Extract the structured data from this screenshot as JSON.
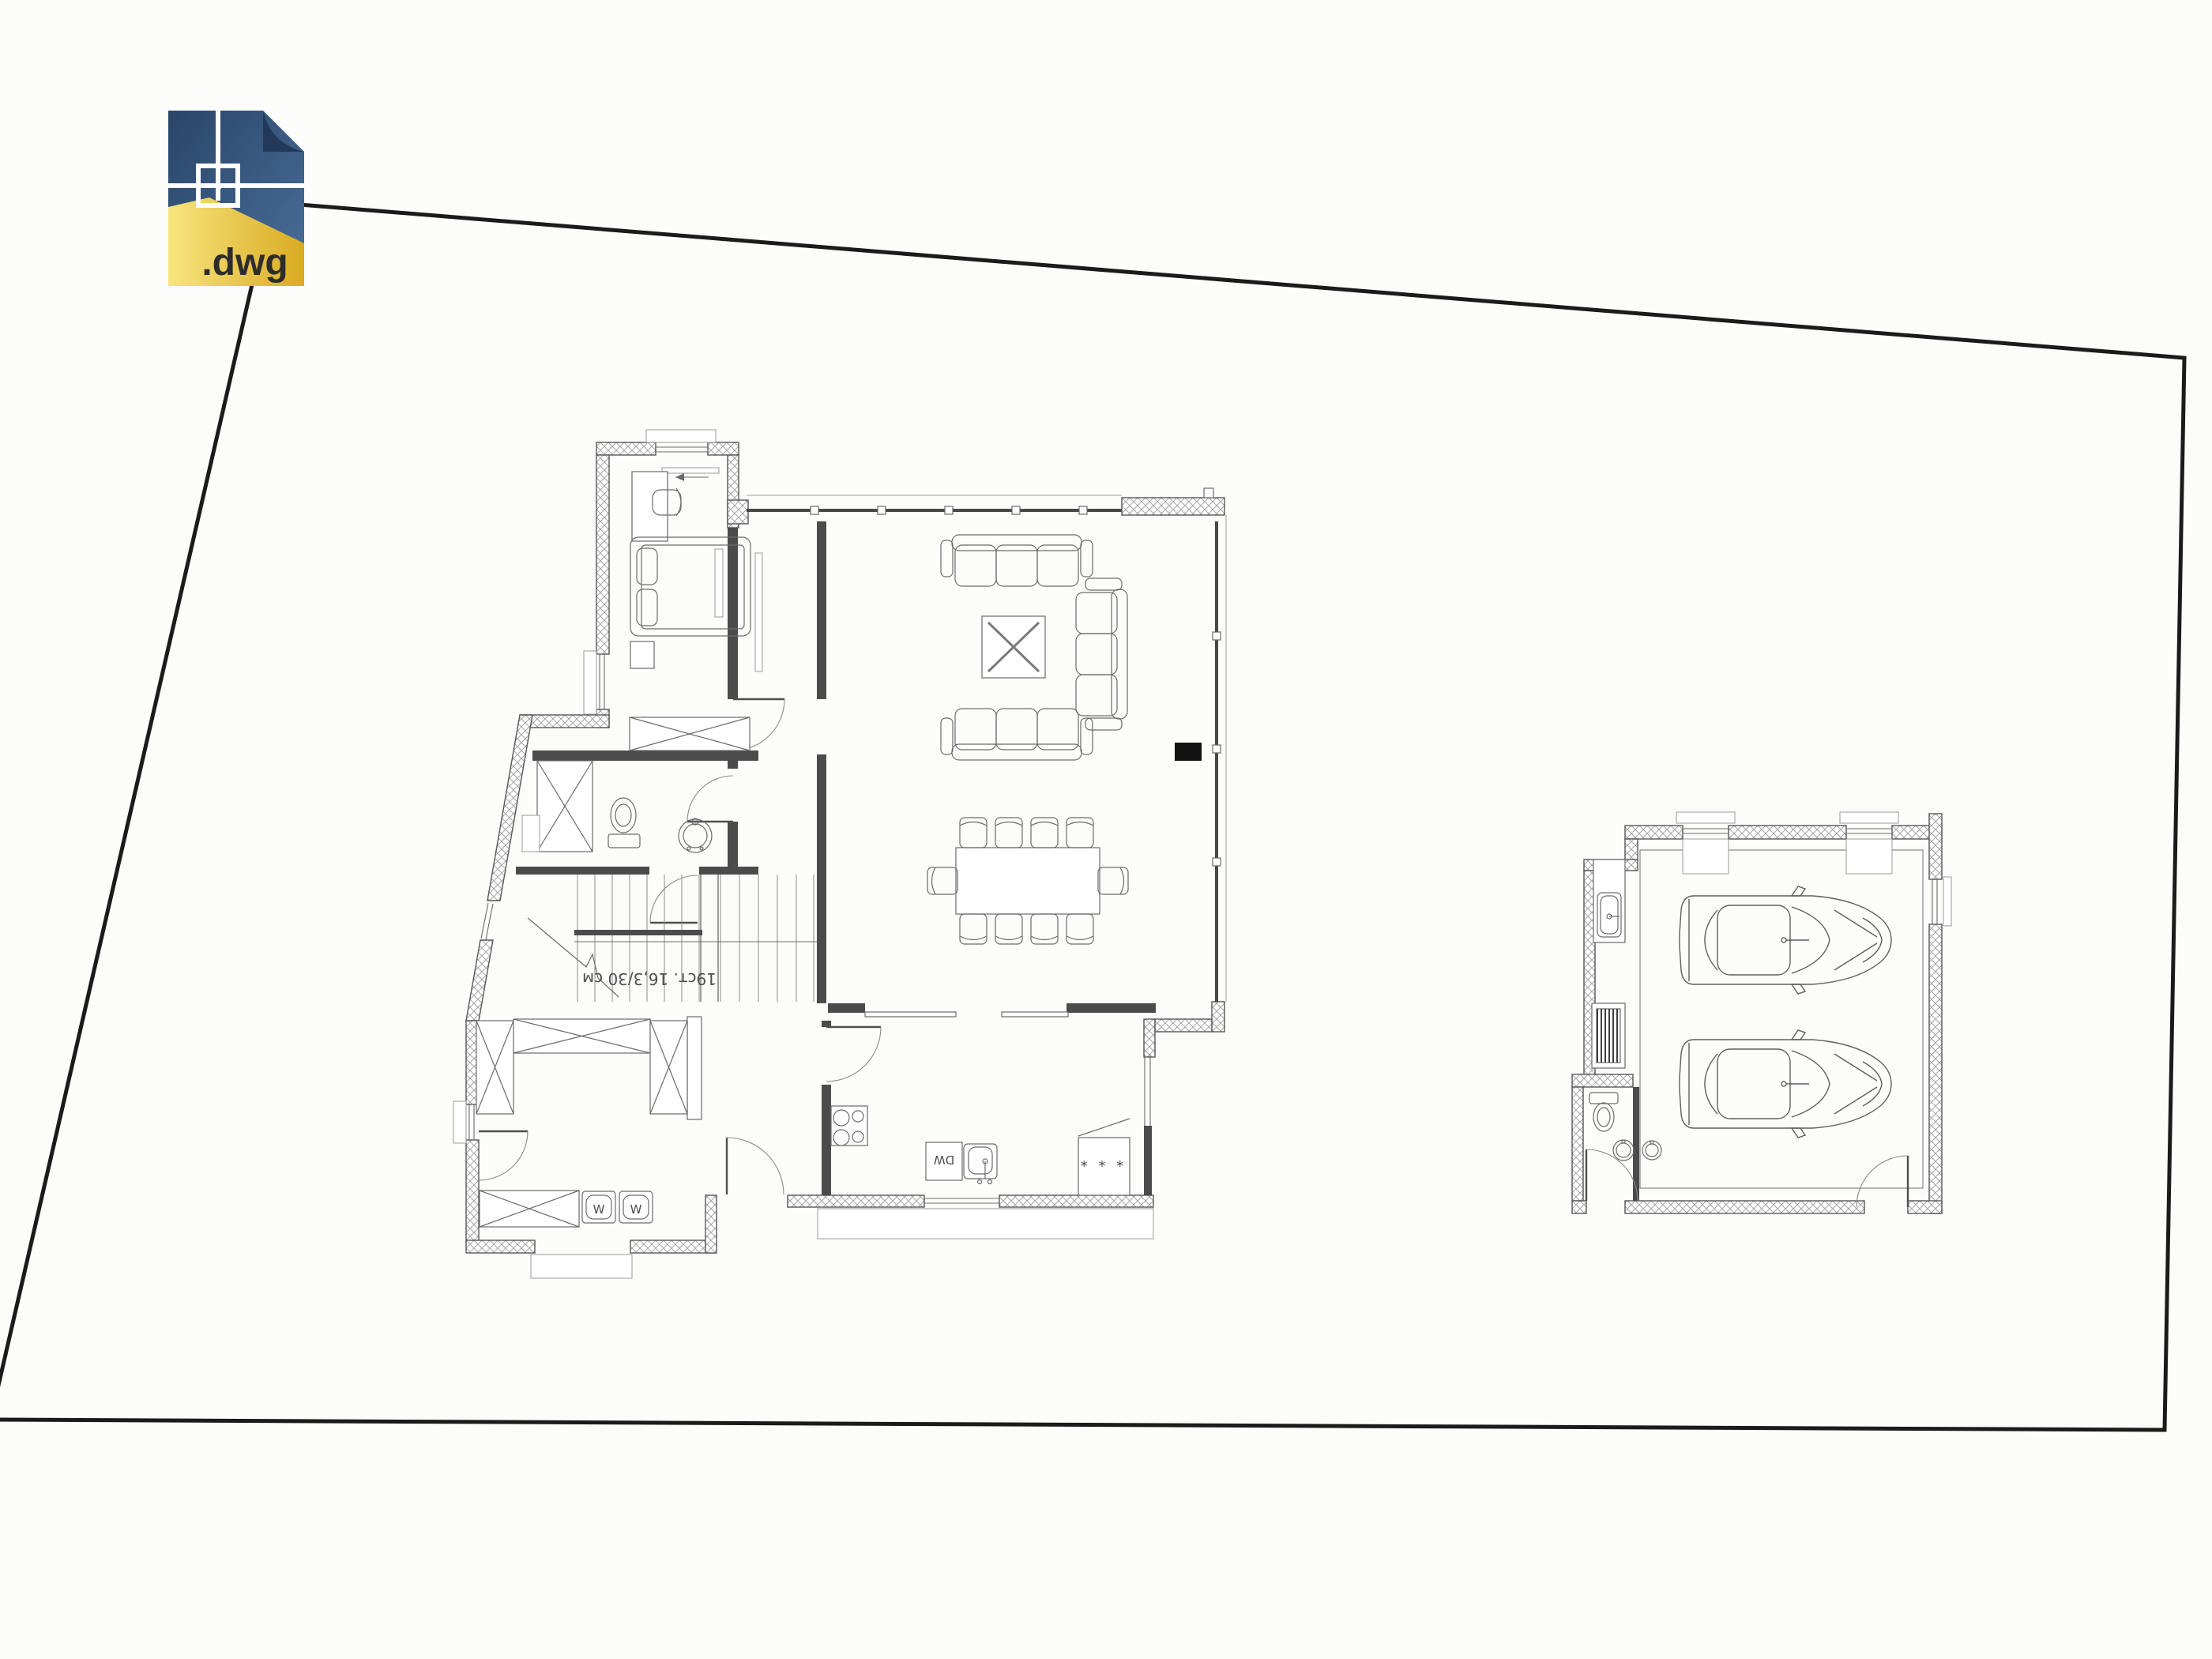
{
  "file_icon": {
    "label": ".dwg",
    "colors": {
      "blue_top": "#2a4568",
      "blue_bottom": "#4a6f9a",
      "fold": "#22395a",
      "yellow_left": "#f6df6e",
      "yellow_right": "#d9ab22",
      "crosshair": "#ffffff",
      "text": "#2d2d2d"
    }
  },
  "drawing": {
    "type": "architectural-floor-plan",
    "stairs_annotation": "19ст. 16,3/30 см",
    "kitchen": {
      "dishwasher_label": "DW",
      "pantry_symbols": "* * *"
    },
    "laundry": {
      "washer_left_label": "W",
      "washer_right_label": "W"
    },
    "counts": {
      "dining_chairs": 10,
      "sofas": 3,
      "cars": 2,
      "garage_windows": 2
    },
    "colors": {
      "background": "#fcfcfb",
      "boundary_line": "#1b1b1b",
      "wall_hatch": "#a3a3a3",
      "line_work": "#5a5a5a",
      "fireplace": "#121212"
    }
  }
}
